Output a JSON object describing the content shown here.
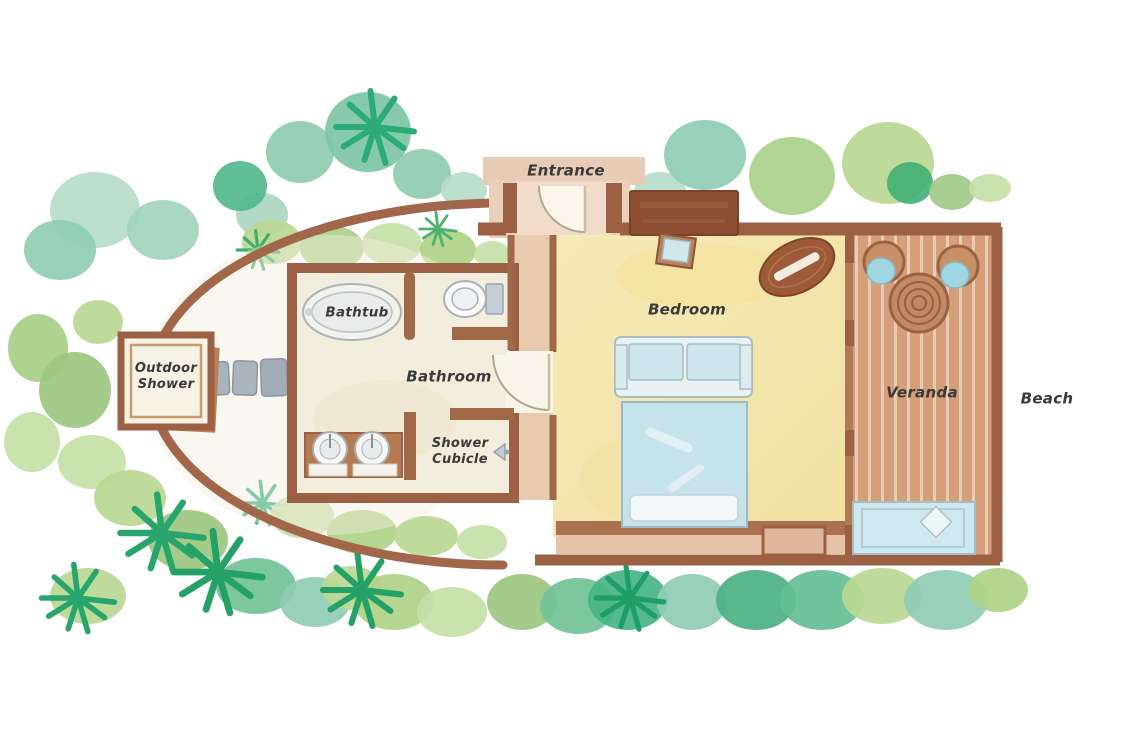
{
  "title": "Beach villa floor plan",
  "labels": {
    "entrance": "Entrance",
    "bathtub": "Bathtub",
    "bathroom": "Bathroom",
    "outdoor_shower": [
      "Outdoor",
      "Shower"
    ],
    "shower_cubicle": [
      "Shower",
      "Cubicle"
    ],
    "bedroom": "Bedroom",
    "veranda": "Veranda",
    "beach": "Beach"
  },
  "features": {
    "furniture_icons": [
      "bathtub",
      "toilet",
      "double-sink-vanity",
      "wardrobe",
      "side-table",
      "dressing-table",
      "sofa",
      "double-bed",
      "deck-chair",
      "deck-chair",
      "round-deck-table",
      "sun-lounger",
      "stepping-stones",
      "door-swing"
    ]
  },
  "palette": {
    "wall_brown": "#9c6144",
    "dark_wood": "#8d4f33",
    "wall_pink": "#e9cab1",
    "bedroom_floor": "#f5e7ae",
    "bathroom_floor": "#f2eddc",
    "deck_wood": "#d8a27d",
    "cushion_blue": "#bfe0ea",
    "foliage_teal": "#7cc5a4",
    "foliage_green": "#a9d089",
    "stone_grey": "#a9b3bc",
    "text": "#3a3a3a"
  }
}
